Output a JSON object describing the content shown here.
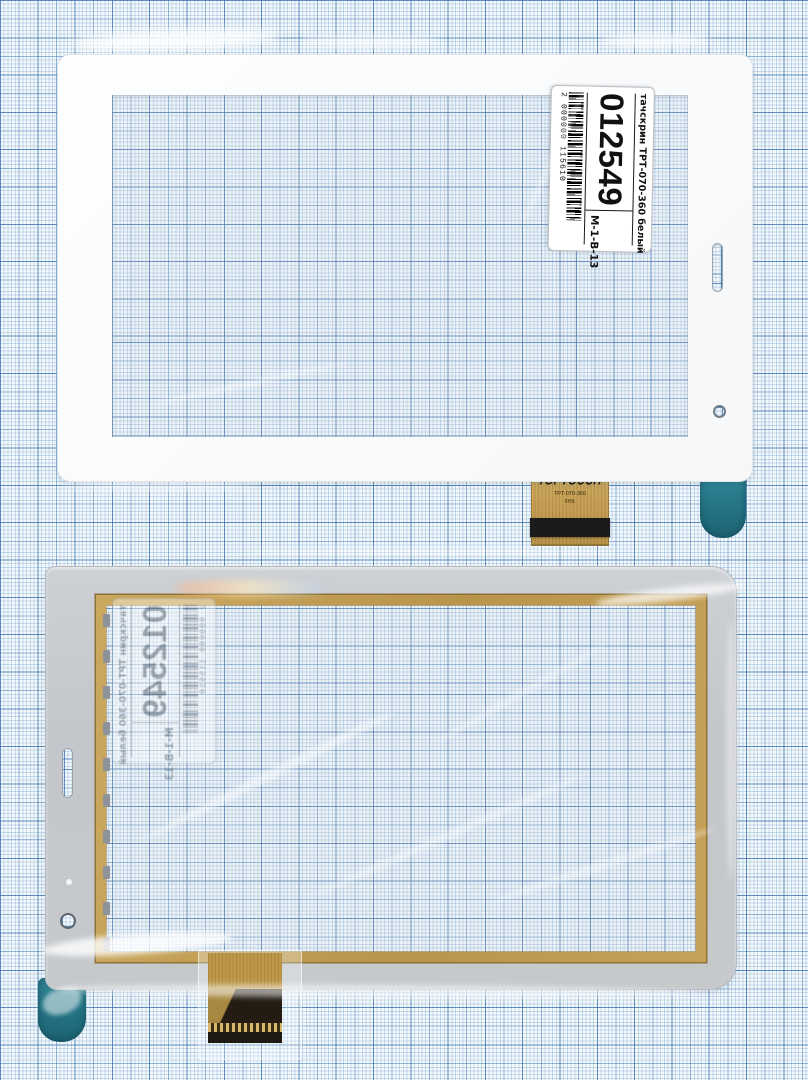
{
  "product_label": {
    "code": "012549",
    "product": "тачскрин ТРТ-070-360 белый",
    "model": "M-1-B-13",
    "barcode_number": "2 000000 115610"
  },
  "flex_cable": {
    "brand": "TOPTOUCH",
    "part": "TPT-070-360",
    "rev": "FHX"
  },
  "colors": {
    "graph_paper_line": "#6f9fca",
    "gold_tape": "#c2a057",
    "teal_pull_tab": "#257687",
    "back_liner_gray": "#c6c9cd",
    "front_bezel_white": "#fcfdfe"
  }
}
